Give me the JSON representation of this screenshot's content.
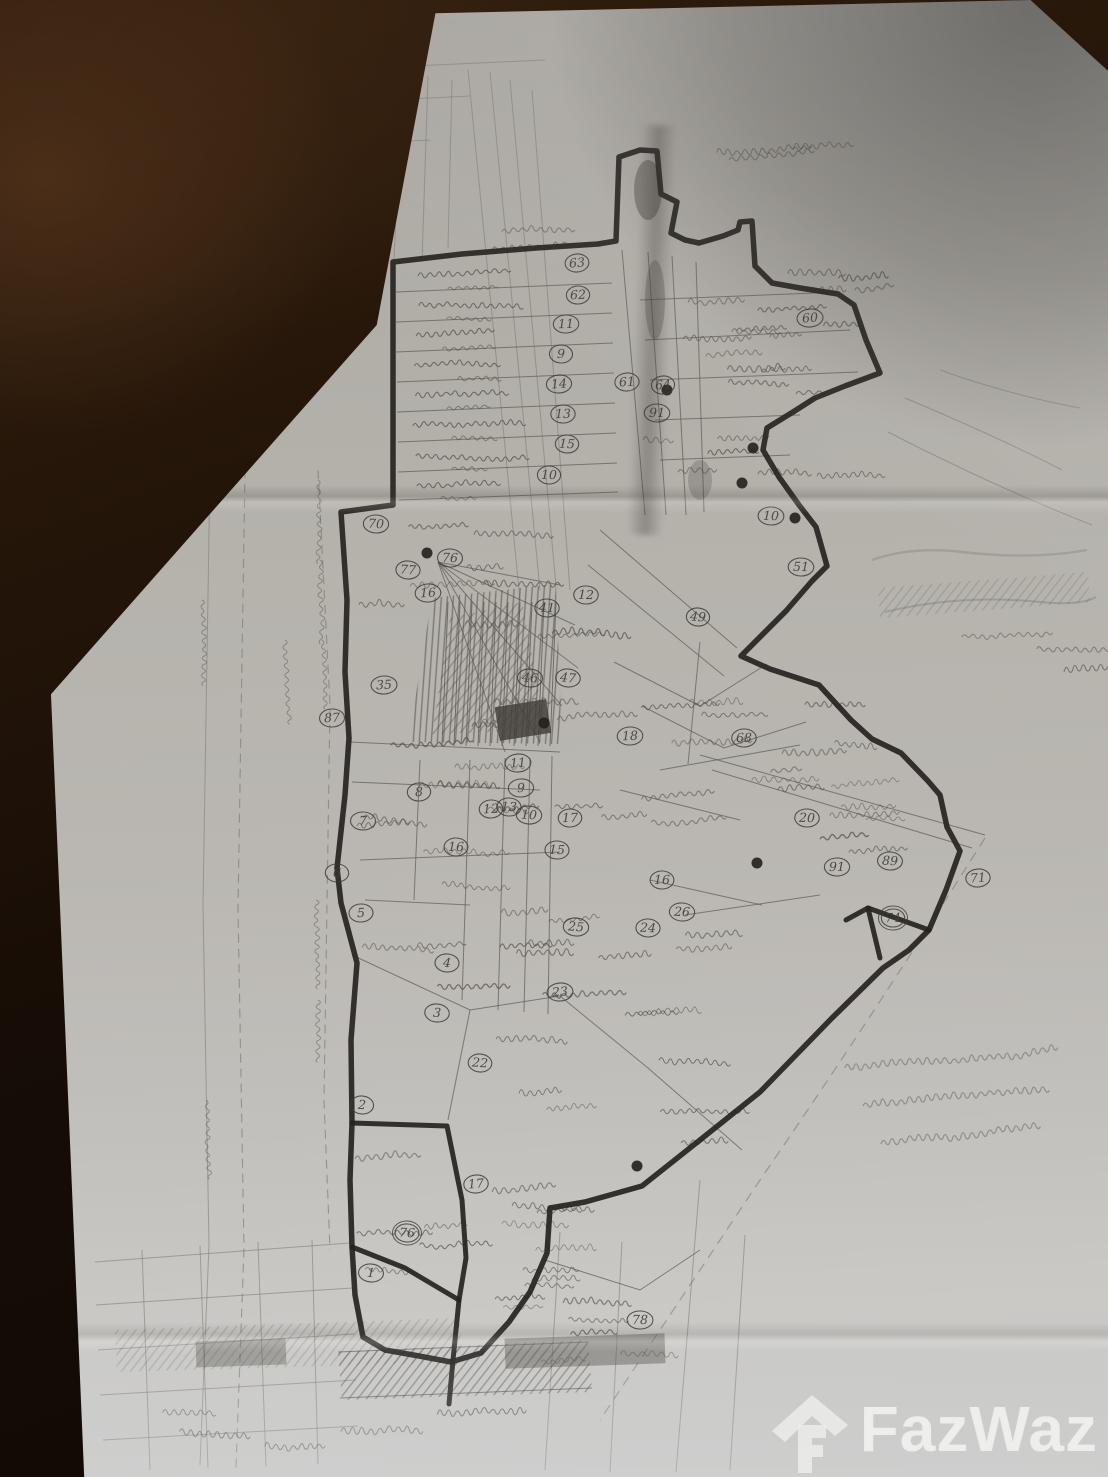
{
  "watermark": {
    "icon": "house-icon",
    "text": "FazWaz"
  },
  "map": {
    "description_colors": {
      "paper": "#b5b2ad",
      "ink": "#26231f",
      "pencil": "#76736c",
      "wood": "#1c1109",
      "watermark_white": "#fcfcfa"
    },
    "parcel_numbers": [
      {
        "n": "63",
        "x": 577,
        "y": 263
      },
      {
        "n": "62",
        "x": 578,
        "y": 295
      },
      {
        "n": "11",
        "x": 566,
        "y": 324
      },
      {
        "n": "9",
        "x": 561,
        "y": 354
      },
      {
        "n": "14",
        "x": 559,
        "y": 384
      },
      {
        "n": "61",
        "x": 627,
        "y": 382
      },
      {
        "n": "64",
        "x": 663,
        "y": 385
      },
      {
        "n": "91",
        "x": 657,
        "y": 413
      },
      {
        "n": "13",
        "x": 563,
        "y": 414
      },
      {
        "n": "15",
        "x": 567,
        "y": 444
      },
      {
        "n": "10",
        "x": 549,
        "y": 475
      },
      {
        "n": "70",
        "x": 376,
        "y": 524
      },
      {
        "n": "76",
        "x": 450,
        "y": 558
      },
      {
        "n": "77",
        "x": 408,
        "y": 570
      },
      {
        "n": "16",
        "x": 428,
        "y": 593
      },
      {
        "n": "12",
        "x": 586,
        "y": 595
      },
      {
        "n": "41",
        "x": 547,
        "y": 608
      },
      {
        "n": "60",
        "x": 810,
        "y": 318
      },
      {
        "n": "10",
        "x": 771,
        "y": 516
      },
      {
        "n": "51",
        "x": 801,
        "y": 567
      },
      {
        "n": "49",
        "x": 698,
        "y": 617
      },
      {
        "n": "35",
        "x": 384,
        "y": 685
      },
      {
        "n": "87",
        "x": 332,
        "y": 718
      },
      {
        "n": "46",
        "x": 530,
        "y": 678
      },
      {
        "n": "47",
        "x": 568,
        "y": 678
      },
      {
        "n": "18",
        "x": 630,
        "y": 736
      },
      {
        "n": "68",
        "x": 744,
        "y": 738
      },
      {
        "n": "20",
        "x": 807,
        "y": 818
      },
      {
        "n": "11",
        "x": 518,
        "y": 763
      },
      {
        "n": "9",
        "x": 521,
        "y": 788
      },
      {
        "n": "8",
        "x": 419,
        "y": 792
      },
      {
        "n": "12",
        "x": 491,
        "y": 809
      },
      {
        "n": "13",
        "x": 509,
        "y": 807
      },
      {
        "n": "10",
        "x": 529,
        "y": 815
      },
      {
        "n": "17",
        "x": 570,
        "y": 818
      },
      {
        "n": "7",
        "x": 363,
        "y": 821
      },
      {
        "n": "16",
        "x": 456,
        "y": 847
      },
      {
        "n": "15",
        "x": 557,
        "y": 850
      },
      {
        "n": "6",
        "x": 337,
        "y": 873
      },
      {
        "n": "5",
        "x": 361,
        "y": 913
      },
      {
        "n": "25",
        "x": 576,
        "y": 927
      },
      {
        "n": "16",
        "x": 662,
        "y": 880
      },
      {
        "n": "26",
        "x": 682,
        "y": 912
      },
      {
        "n": "24",
        "x": 648,
        "y": 928
      },
      {
        "n": "91",
        "x": 837,
        "y": 867
      },
      {
        "n": "89",
        "x": 890,
        "y": 861
      },
      {
        "n": "74",
        "x": 893,
        "y": 918,
        "double": true
      },
      {
        "n": "71",
        "x": 978,
        "y": 878
      },
      {
        "n": "4",
        "x": 447,
        "y": 963
      },
      {
        "n": "23",
        "x": 560,
        "y": 992
      },
      {
        "n": "3",
        "x": 437,
        "y": 1013
      },
      {
        "n": "22",
        "x": 480,
        "y": 1063
      },
      {
        "n": "2",
        "x": 362,
        "y": 1105
      },
      {
        "n": "17",
        "x": 476,
        "y": 1184
      },
      {
        "n": "76",
        "x": 407,
        "y": 1233,
        "double": true
      },
      {
        "n": "1",
        "x": 371,
        "y": 1273
      },
      {
        "n": "78",
        "x": 640,
        "y": 1320
      }
    ],
    "survey_dots": [
      [
        667,
        390
      ],
      [
        753,
        448
      ],
      [
        742,
        483
      ],
      [
        795,
        518
      ],
      [
        757,
        863
      ],
      [
        544,
        723
      ],
      [
        637,
        1166
      ],
      [
        427,
        553
      ]
    ],
    "handwritten_note": {
      "x": 845,
      "y": 1068,
      "lines_count": 3,
      "legibility": "illegible pencil Thai cursive"
    }
  }
}
